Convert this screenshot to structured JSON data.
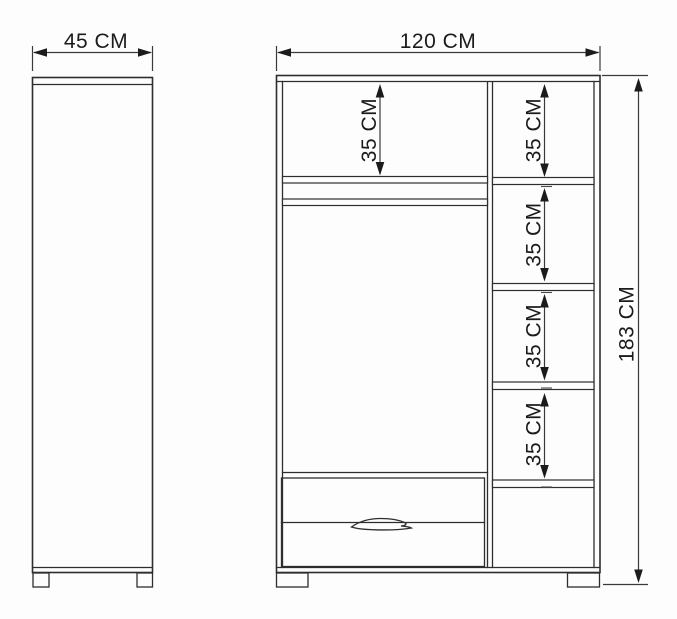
{
  "diagram": {
    "type": "furniture-dimension-drawing",
    "views": {
      "side": {
        "width_label": "45 CM"
      },
      "front": {
        "width_label": "120 CM",
        "height_label": "183 CM",
        "compartments": {
          "left_top": "35 CM",
          "right_1": "35 CM",
          "right_2": "35 CM",
          "right_3": "35 CM",
          "right_4": "35 CM"
        }
      }
    },
    "colors": {
      "background": "#fdfdfd",
      "outline": "#2e2e2e",
      "dimension_line": "#3a3a3a",
      "text": "#1b1b1b"
    }
  }
}
